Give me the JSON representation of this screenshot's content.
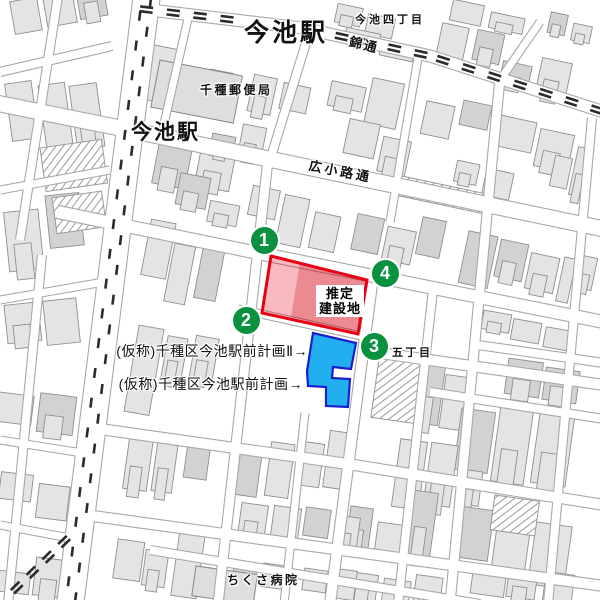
{
  "map": {
    "labels": {
      "station_top": "今池駅",
      "station_left": "今池駅",
      "district_ne": "今池四丁目",
      "road_nishiki": "錦通",
      "road_hirokoji": "広小路通",
      "post_office": "千種郵便局",
      "district_e": "五丁目",
      "hospital": "ちくさ病院"
    },
    "annotations": {
      "site_label": [
        "推定",
        "建設地"
      ],
      "plan2_label": "(仮称)千種区今池駅前計画Ⅱ→",
      "plan1_label": "(仮称)千種区今池駅前計画→",
      "markers": [
        {
          "label": "1",
          "x": 264,
          "y": 240
        },
        {
          "label": "2",
          "x": 246,
          "y": 320
        },
        {
          "label": "3",
          "x": 374,
          "y": 346
        },
        {
          "label": "4",
          "x": 385,
          "y": 273
        }
      ],
      "site_red_polygon": "271,256 367,280 358,334 262,313",
      "site_red_inner": "300,262 367,280 358,334 291,317",
      "plan_blue_polygon": "313,333 356,343 351,369 333,367 332,378 350,379 348,407 326,406 326,387 308,386 307,371"
    },
    "colors": {
      "marker_green": "#0a9140",
      "site_red_stroke": "#e60012",
      "site_red_fill": "rgba(230,0,18,0.27)",
      "site_red_inner_fill": "rgba(200,0,20,0.26)",
      "plan_blue_fill": "#22aff0",
      "plan_blue_stroke": "#1a1ecc"
    }
  }
}
